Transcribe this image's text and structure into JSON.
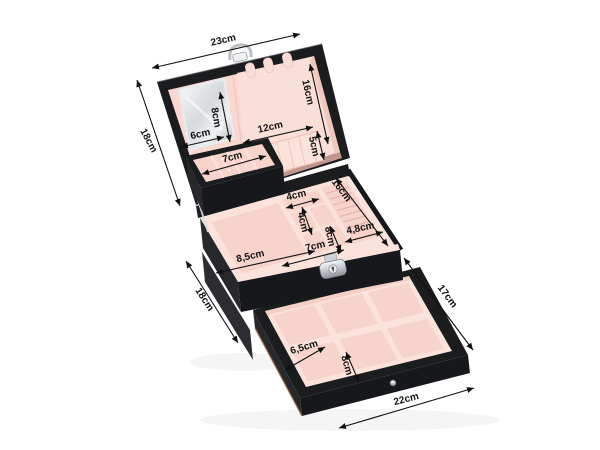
{
  "image": {
    "subject": "black jewelry organizer box with pink interior, open mirrored lid, removable earring tray, compartment tray and pull-out drawer, annotated with centimetre dimensions on white background"
  },
  "colors": {
    "background": "#ffffff",
    "case_black": "#1b1c1e",
    "case_front": "#17181b",
    "case_left": "#26282c",
    "case_left2": "#2b2d31",
    "lid_pink": "#f8d8d1",
    "lid_panel": "#fadfd8",
    "interior_pink": "#f6d3cb",
    "interior_pink_light": "#fbe3dc",
    "interior_pink_deep": "#eec2b8",
    "ridge_pink": "#e6b3a8",
    "seam_pink": "#eec3ba",
    "metal_silver": "#cfd4d8",
    "accent_copper": "#9a5c35",
    "annotation_black": "#111111"
  },
  "annotations": {
    "lid": {
      "width": "23cm",
      "side": "18cm",
      "mirror_height": "8cm",
      "mirror_width": "6cm",
      "inner_right": "16cm",
      "pocket_width": "12cm",
      "pocket_height": "5cm"
    },
    "earring_tray": {
      "width": "7cm"
    },
    "main_tray": {
      "small_cell_width": "4cm",
      "small_cell_depth": "4cm",
      "inner_right": "16cm",
      "middle_depth": "8cm",
      "ring_section": "4,8cm",
      "front_width": "7cm",
      "left_compartment": "8,5cm",
      "case_side": "18cm"
    },
    "drawer": {
      "side": "17cm",
      "cell_width": "6,5cm",
      "cell_depth": "8cm",
      "front_width": "22cm"
    }
  }
}
